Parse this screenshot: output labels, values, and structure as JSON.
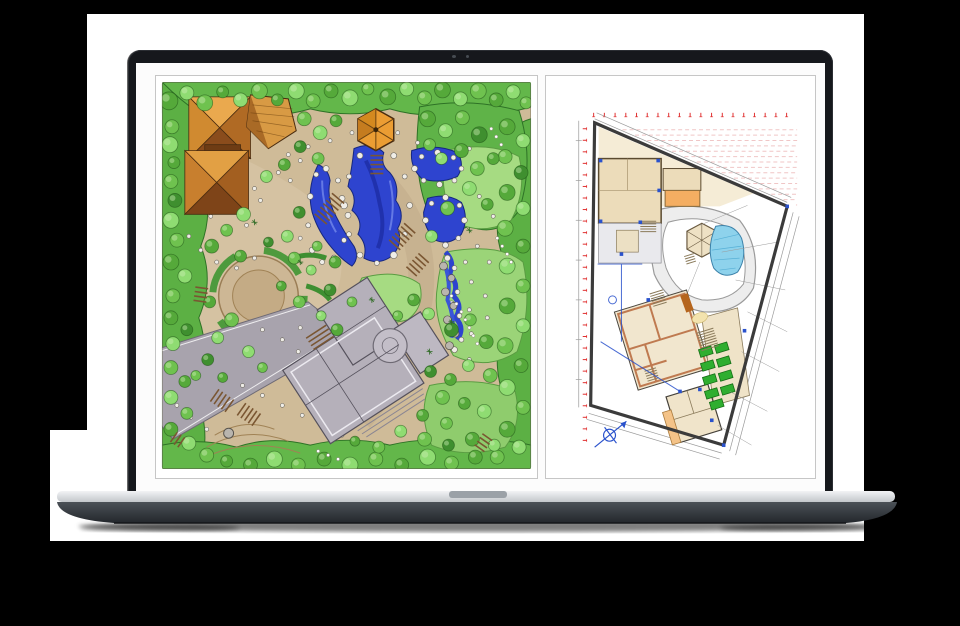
{
  "meta": {
    "description": "Silver laptop mockup displaying two landscape-architecture drawings side by side",
    "left_panel_label": "Hand-drawn landscape master plan",
    "right_panel_label": "CAD site plan with dimension annotations"
  },
  "palette": {
    "page_bg": "#000000",
    "backdrop": "#ffffff",
    "bezel": "#16181c",
    "display_bg": "#fcfcfc",
    "panel_border": "#c6c6c6",
    "base_silver_hi": "#f2f3f5",
    "base_silver_lo": "#c3c7cb",
    "notch": "#9ba1a7",
    "base_dark_hi": "#4b5157",
    "base_dark_lo": "#23272c",
    "sand": "#cfbb98",
    "sand_light": "#dbcaab",
    "path_edge": "#8d7352",
    "green_mid": "#63b74a",
    "green_dark": "#4d9c3a",
    "green_edge": "#2e7226",
    "lawn": "#a6db82",
    "lawn2": "#93cf6e",
    "pond": "#2e44cf",
    "pond_dark": "#1b2a9e",
    "pond_hi": "#7287ea",
    "rock_fill": "#efede7",
    "rock_edge": "#6b675f",
    "roof_light": "#eaa94e",
    "roof_mid": "#d08a30",
    "roof_right": "#b06a24",
    "roof_dark": "#8a4c1c",
    "roof_deep": "#6e3c14",
    "roof_line": "#4a2c10",
    "house_gray": "#b5b0ba",
    "house_line": "#55515c",
    "road_gray": "#a8a3ad",
    "cad_cream": "#f5ecd6",
    "cad_beige": "#ecdcba",
    "cad_orange": "#f4ae62",
    "cad_wall": "#bf7a50",
    "cad_green": "#2fae2f",
    "cad_pool": "#8ed2ec",
    "cad_blue": "#2a52cc",
    "cad_red": "#e03030",
    "cad_red_faint": "#f0c6c6",
    "cad_line": "#3b3b3b",
    "cad_dim": "#9a9a9a"
  },
  "sketch": {
    "tree_colors": [
      "#6fc24f",
      "#55a93a",
      "#8fdc72",
      "#3f8f2f"
    ],
    "trees": [
      [
        168,
        100,
        9,
        1
      ],
      [
        186,
        92,
        7,
        2
      ],
      [
        204,
        102,
        8,
        0
      ],
      [
        222,
        91,
        6,
        1
      ],
      [
        240,
        99,
        7,
        2
      ],
      [
        259,
        90,
        8,
        0
      ],
      [
        277,
        99,
        6,
        1
      ],
      [
        296,
        90,
        8,
        2
      ],
      [
        313,
        100,
        7,
        0
      ],
      [
        331,
        90,
        7,
        1
      ],
      [
        350,
        97,
        8,
        2
      ],
      [
        368,
        88,
        6,
        0
      ],
      [
        388,
        96,
        8,
        1
      ],
      [
        407,
        88,
        7,
        2
      ],
      [
        425,
        97,
        7,
        0
      ],
      [
        443,
        89,
        8,
        1
      ],
      [
        461,
        98,
        7,
        2
      ],
      [
        479,
        90,
        8,
        0
      ],
      [
        497,
        99,
        7,
        1
      ],
      [
        514,
        91,
        7,
        2
      ],
      [
        527,
        102,
        6,
        0
      ],
      [
        171,
        126,
        7,
        0
      ],
      [
        169,
        144,
        8,
        2
      ],
      [
        173,
        162,
        6,
        1
      ],
      [
        170,
        181,
        7,
        0
      ],
      [
        174,
        200,
        7,
        3
      ],
      [
        170,
        220,
        8,
        2
      ],
      [
        176,
        240,
        7,
        0
      ],
      [
        170,
        262,
        8,
        1
      ],
      [
        184,
        276,
        7,
        2
      ],
      [
        172,
        296,
        7,
        0
      ],
      [
        170,
        318,
        7,
        1
      ],
      [
        186,
        330,
        6,
        3
      ],
      [
        172,
        344,
        7,
        2
      ],
      [
        170,
        368,
        7,
        0
      ],
      [
        184,
        382,
        6,
        1
      ],
      [
        170,
        398,
        7,
        2
      ],
      [
        186,
        414,
        6,
        0
      ],
      [
        170,
        430,
        7,
        1
      ],
      [
        188,
        444,
        7,
        2
      ],
      [
        206,
        456,
        7,
        0
      ],
      [
        226,
        462,
        6,
        1
      ],
      [
        508,
        126,
        8,
        1
      ],
      [
        524,
        140,
        7,
        2
      ],
      [
        506,
        156,
        7,
        0
      ],
      [
        522,
        172,
        7,
        3
      ],
      [
        508,
        192,
        8,
        1
      ],
      [
        524,
        208,
        7,
        2
      ],
      [
        506,
        228,
        8,
        0
      ],
      [
        524,
        246,
        7,
        1
      ],
      [
        508,
        266,
        8,
        2
      ],
      [
        524,
        286,
        7,
        0
      ],
      [
        508,
        306,
        8,
        1
      ],
      [
        524,
        326,
        7,
        2
      ],
      [
        506,
        346,
        8,
        0
      ],
      [
        522,
        366,
        7,
        1
      ],
      [
        508,
        388,
        8,
        2
      ],
      [
        524,
        408,
        7,
        0
      ],
      [
        508,
        430,
        8,
        1
      ],
      [
        520,
        448,
        7,
        2
      ],
      [
        498,
        458,
        7,
        0
      ],
      [
        250,
        466,
        7,
        1
      ],
      [
        274,
        460,
        8,
        2
      ],
      [
        298,
        466,
        7,
        0
      ],
      [
        324,
        460,
        7,
        1
      ],
      [
        350,
        466,
        8,
        2
      ],
      [
        376,
        460,
        7,
        0
      ],
      [
        402,
        466,
        7,
        1
      ],
      [
        428,
        458,
        8,
        2
      ],
      [
        452,
        464,
        7,
        0
      ],
      [
        476,
        458,
        7,
        1
      ],
      [
        428,
        118,
        8,
        1
      ],
      [
        446,
        130,
        7,
        2
      ],
      [
        463,
        117,
        7,
        0
      ],
      [
        480,
        134,
        8,
        3
      ],
      [
        462,
        150,
        7,
        1
      ],
      [
        442,
        158,
        6,
        2
      ],
      [
        478,
        168,
        7,
        0
      ],
      [
        494,
        158,
        6,
        1
      ],
      [
        430,
        144,
        6,
        0
      ],
      [
        470,
        188,
        7,
        2
      ],
      [
        488,
        204,
        6,
        1
      ],
      [
        448,
        208,
        7,
        0
      ],
      [
        432,
        236,
        6,
        2
      ],
      [
        304,
        118,
        7,
        0
      ],
      [
        320,
        132,
        7,
        2
      ],
      [
        336,
        120,
        6,
        1
      ],
      [
        300,
        146,
        6,
        3
      ],
      [
        318,
        158,
        6,
        0
      ],
      [
        284,
        164,
        6,
        1
      ],
      [
        266,
        176,
        6,
        2
      ],
      [
        243,
        214,
        7,
        2
      ],
      [
        226,
        230,
        6,
        0
      ],
      [
        211,
        246,
        7,
        1
      ],
      [
        299,
        212,
        6,
        3
      ],
      [
        287,
        236,
        6,
        2
      ],
      [
        317,
        246,
        5,
        0
      ],
      [
        335,
        262,
        6,
        1
      ],
      [
        231,
        320,
        7,
        0
      ],
      [
        217,
        338,
        6,
        2
      ],
      [
        209,
        302,
        6,
        1
      ],
      [
        330,
        290,
        6,
        3
      ],
      [
        352,
        302,
        5,
        0
      ],
      [
        414,
        300,
        6,
        1
      ],
      [
        398,
        316,
        5,
        0
      ],
      [
        429,
        314,
        6,
        2
      ],
      [
        452,
        330,
        7,
        3
      ],
      [
        471,
        320,
        6,
        0
      ],
      [
        487,
        342,
        7,
        1
      ],
      [
        469,
        366,
        6,
        2
      ],
      [
        491,
        376,
        7,
        0
      ],
      [
        451,
        380,
        6,
        1
      ],
      [
        431,
        372,
        6,
        3
      ],
      [
        443,
        398,
        7,
        0
      ],
      [
        465,
        404,
        6,
        1
      ],
      [
        485,
        412,
        7,
        2
      ],
      [
        447,
        424,
        6,
        0
      ],
      [
        423,
        416,
        6,
        1
      ],
      [
        401,
        432,
        6,
        2
      ],
      [
        425,
        440,
        7,
        0
      ],
      [
        449,
        446,
        6,
        3
      ],
      [
        473,
        440,
        7,
        1
      ],
      [
        495,
        446,
        6,
        2
      ],
      [
        379,
        448,
        6,
        0
      ],
      [
        355,
        442,
        5,
        1
      ],
      [
        248,
        352,
        6,
        2
      ],
      [
        262,
        368,
        5,
        0
      ],
      [
        240,
        256,
        6,
        1
      ],
      [
        268,
        242,
        5,
        3
      ],
      [
        294,
        258,
        6,
        0
      ],
      [
        311,
        270,
        5,
        2
      ],
      [
        281,
        286,
        5,
        1
      ],
      [
        299,
        302,
        6,
        0
      ],
      [
        321,
        316,
        5,
        2
      ],
      [
        337,
        330,
        6,
        1
      ],
      [
        207,
        360,
        6,
        3
      ],
      [
        195,
        376,
        5,
        0
      ],
      [
        222,
        378,
        5,
        1
      ]
    ],
    "rocks": [
      [
        410,
        205,
        3
      ],
      [
        405,
        234,
        2.5
      ],
      [
        394,
        255,
        3.5
      ],
      [
        377,
        263,
        2.5
      ],
      [
        360,
        255,
        3
      ],
      [
        349,
        234,
        2.5
      ],
      [
        344,
        205,
        3.5
      ],
      [
        349,
        176,
        2.5
      ],
      [
        360,
        155,
        3
      ],
      [
        377,
        147,
        2.5
      ],
      [
        394,
        155,
        3
      ],
      [
        405,
        176,
        2.5
      ],
      [
        348,
        215,
        3
      ],
      [
        344,
        240,
        2.5
      ],
      [
        334,
        258,
        3
      ],
      [
        322,
        262,
        2.5
      ],
      [
        312,
        250,
        3
      ],
      [
        308,
        225,
        2.5
      ],
      [
        310,
        196,
        3
      ],
      [
        316,
        174,
        2.5
      ],
      [
        326,
        168,
        3
      ],
      [
        338,
        180,
        2.5
      ],
      [
        342,
        198,
        3
      ],
      [
        462,
        168,
        2.5
      ],
      [
        455,
        180,
        2.5
      ],
      [
        440,
        184,
        3
      ],
      [
        424,
        180,
        2.5
      ],
      [
        415,
        168,
        3
      ],
      [
        422,
        156,
        2.5
      ],
      [
        438,
        152,
        3
      ],
      [
        454,
        157,
        2.5
      ],
      [
        465,
        220,
        3
      ],
      [
        459,
        238,
        2.5
      ],
      [
        446,
        245,
        3
      ],
      [
        432,
        238,
        2.5
      ],
      [
        426,
        220,
        3
      ],
      [
        432,
        203,
        2.5
      ],
      [
        446,
        197,
        3
      ],
      [
        460,
        205,
        2.5
      ],
      [
        448,
        258,
        3
      ],
      [
        455,
        268,
        2.5
      ],
      [
        450,
        280,
        3
      ],
      [
        458,
        292,
        2.5
      ],
      [
        452,
        304,
        3
      ],
      [
        460,
        316,
        2.5
      ],
      [
        454,
        328,
        3
      ],
      [
        462,
        340,
        2.5
      ],
      [
        455,
        350,
        3
      ],
      [
        300,
        160,
        2
      ],
      [
        290,
        180,
        2
      ],
      [
        260,
        200,
        2
      ],
      [
        246,
        225,
        2
      ],
      [
        300,
        238,
        2
      ],
      [
        330,
        140,
        2
      ],
      [
        352,
        132,
        2
      ],
      [
        398,
        132,
        2
      ],
      [
        418,
        142,
        2
      ],
      [
        470,
        148,
        2
      ],
      [
        254,
        258,
        2
      ],
      [
        236,
        268,
        2
      ],
      [
        300,
        328,
        2
      ],
      [
        342,
        352,
        2
      ],
      [
        368,
        344,
        2
      ],
      [
        390,
        338,
        2
      ],
      [
        200,
        250,
        2
      ],
      [
        216,
        262,
        2
      ],
      [
        262,
        330,
        2
      ],
      [
        282,
        340,
        2
      ],
      [
        298,
        352,
        2
      ],
      [
        188,
        236,
        2
      ],
      [
        210,
        216,
        2
      ],
      [
        230,
        200,
        2
      ],
      [
        254,
        188,
        2
      ],
      [
        278,
        172,
        2
      ],
      [
        288,
        154,
        2
      ],
      [
        308,
        146,
        2
      ],
      [
        480,
        196,
        2
      ],
      [
        494,
        216,
        2
      ],
      [
        478,
        246,
        2
      ],
      [
        466,
        262,
        2
      ],
      [
        490,
        262,
        2
      ],
      [
        472,
        282,
        2
      ],
      [
        486,
        296,
        2
      ],
      [
        470,
        310,
        2
      ],
      [
        488,
        318,
        2
      ],
      [
        472,
        334,
        2
      ],
      [
        486,
        346,
        2
      ],
      [
        470,
        360,
        2
      ],
      [
        242,
        386,
        2
      ],
      [
        262,
        396,
        2
      ],
      [
        282,
        406,
        2
      ],
      [
        302,
        416,
        2
      ],
      [
        322,
        426,
        2
      ],
      [
        342,
        436,
        2
      ],
      [
        206,
        430,
        2
      ],
      [
        190,
        418,
        2
      ],
      [
        176,
        406,
        2
      ]
    ],
    "stairs": [
      [
        338,
        198,
        40,
        7,
        16
      ],
      [
        410,
        228,
        42,
        6,
        15
      ],
      [
        424,
        258,
        42,
        5,
        14
      ],
      [
        377,
        155,
        0,
        5,
        13
      ],
      [
        201,
        288,
        8,
        4,
        13
      ],
      [
        214,
        396,
        -55,
        5,
        15
      ],
      [
        241,
        410,
        -55,
        5,
        15
      ],
      [
        173,
        438,
        -55,
        3,
        12
      ],
      [
        488,
        438,
        35,
        4,
        12
      ],
      [
        316,
        332,
        -33,
        4,
        24
      ]
    ],
    "trail_dots": [
      [
        452,
        296
      ],
      [
        457,
        304
      ],
      [
        462,
        312
      ],
      [
        466,
        320
      ],
      [
        470,
        328
      ],
      [
        474,
        336
      ],
      [
        478,
        344
      ],
      [
        498,
        238
      ],
      [
        503,
        246
      ],
      [
        508,
        254
      ],
      [
        512,
        262
      ],
      [
        318,
        452
      ],
      [
        328,
        456
      ],
      [
        338,
        460
      ],
      [
        492,
        128
      ],
      [
        497,
        136
      ],
      [
        502,
        144
      ]
    ],
    "sparkles": [
      [
        372,
        300
      ],
      [
        452,
        322
      ],
      [
        300,
        262
      ],
      [
        470,
        230
      ],
      [
        430,
        352
      ],
      [
        254,
        222
      ]
    ]
  },
  "cad": {
    "ticks_top": {
      "x0": 593,
      "step": 10.8,
      "count": 19,
      "y": 114
    },
    "ticks_left": {
      "x": 584,
      "y0": 128,
      "step": 11.6,
      "count": 28
    },
    "text_rows": {
      "count": 15,
      "y0": 129,
      "step": 5.4,
      "x1": 798
    },
    "bed_size": [
      13,
      8
    ],
    "bed_angle": -17,
    "green_beds": [
      [
        706,
        352
      ],
      [
        722,
        348
      ],
      [
        708,
        366
      ],
      [
        724,
        362
      ],
      [
        710,
        380
      ],
      [
        726,
        376
      ],
      [
        712,
        394
      ],
      [
        728,
        390
      ],
      [
        717,
        405
      ]
    ],
    "stairs": [
      [
        656,
        292,
        -17,
        6,
        14
      ],
      [
        705,
        331,
        -17,
        8,
        18
      ],
      [
        650,
        370,
        -17,
        5,
        12
      ],
      [
        689,
        255,
        -17,
        4,
        10
      ],
      [
        648,
        221,
        0,
        5,
        16
      ]
    ],
    "blue_markers": [
      [
        600,
        160
      ],
      [
        658,
        160
      ],
      [
        600,
        221
      ],
      [
        640,
        222
      ],
      [
        659,
        190
      ],
      [
        788,
        206
      ],
      [
        724,
        446
      ],
      [
        648,
        300
      ],
      [
        700,
        390
      ],
      [
        712,
        421
      ],
      [
        745,
        331
      ],
      [
        621,
        254
      ],
      [
        680,
        392
      ]
    ]
  }
}
